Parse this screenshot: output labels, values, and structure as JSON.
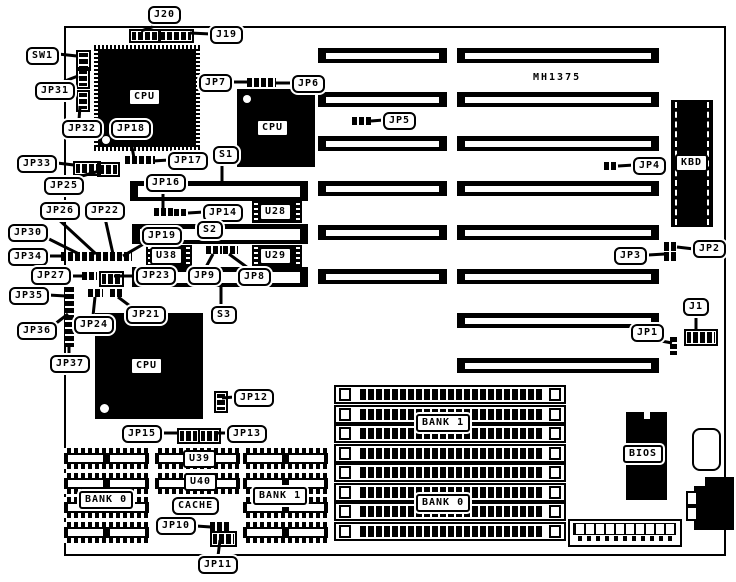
{
  "diagram": {
    "type": "motherboard-layout",
    "board_model": "MH1375",
    "cpu_sites": 3,
    "expansion_slots_16bit": 6,
    "expansion_slots_8bit": 2,
    "simm_sockets": 8,
    "ink_color": "#000000",
    "background_color": "#ffffff"
  },
  "labels": {
    "board_model": "MH1375",
    "j20": "J20",
    "j19": "J19",
    "sw1": "SW1",
    "jp31": "JP31",
    "jp32": "JP32",
    "jp18": "JP18",
    "jp17": "JP17",
    "jp7": "JP7",
    "jp6": "JP6",
    "jp5": "JP5",
    "jp4": "JP4",
    "kbd": "KBD",
    "jp33": "JP33",
    "jp25": "JP25",
    "jp16": "JP16",
    "jp14": "JP14",
    "s1": "S1",
    "s2": "S2",
    "s3": "S3",
    "u28": "U28",
    "u29": "U29",
    "u38": "U38",
    "jp26": "JP26",
    "jp22": "JP22",
    "jp30": "JP30",
    "jp34": "JP34",
    "jp19": "JP19",
    "jp27": "JP27",
    "jp23": "JP23",
    "jp9": "JP9",
    "jp8": "JP8",
    "jp35": "JP35",
    "jp36": "JP36",
    "jp37": "JP37",
    "jp24": "JP24",
    "jp21": "JP21",
    "jp12": "JP12",
    "jp15": "JP15",
    "jp13": "JP13",
    "u39": "U39",
    "u40": "U40",
    "cache": "CACHE",
    "jp10": "JP10",
    "jp11": "JP11",
    "bank0_cache": "BANK 0",
    "bank1_cache": "BANK 1",
    "bank1_simm": "BANK 1",
    "bank0_simm": "BANK 0",
    "bios": "BIOS",
    "jp3": "JP3",
    "jp2": "JP2",
    "jp1": "JP1",
    "j1": "J1",
    "cpu": "CPU"
  }
}
